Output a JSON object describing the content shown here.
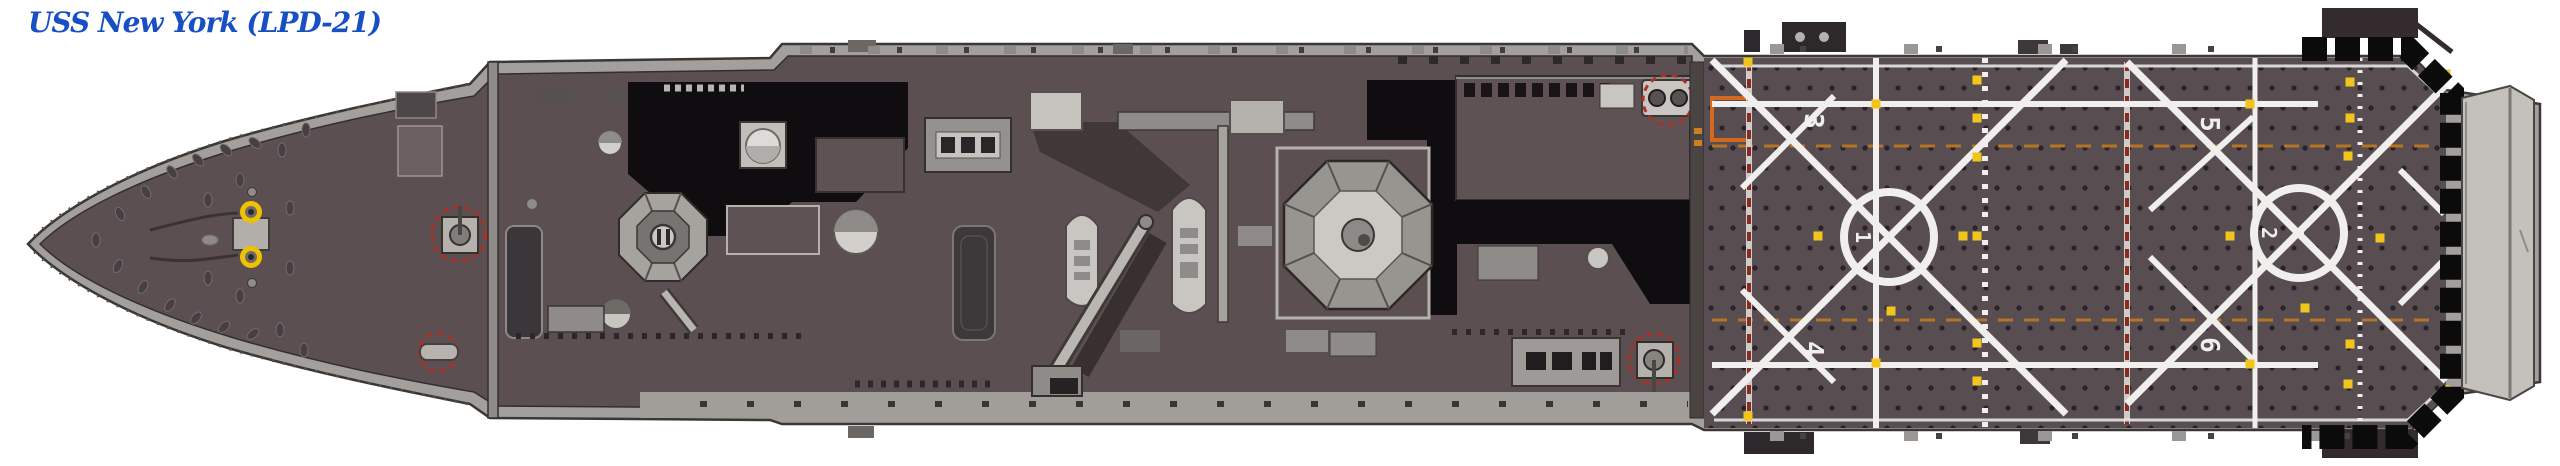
{
  "title": "USS New York (LPD-21)",
  "ship": {
    "name": "USS New York",
    "hull_designation": "LPD-21",
    "view": "overhead deck plan",
    "flight_deck": {
      "spot_labels": {
        "spot1": "1",
        "spot2": "2"
      },
      "line_labels": {
        "line3": "3",
        "line4": "4",
        "line5": "5",
        "line6": "6"
      }
    },
    "colors": {
      "title_blue": "#1850c4",
      "deck_maroon": "#5c4f51",
      "flight_deck": "#584e52",
      "hull_trim": "#a39f9c",
      "superstructure_light": "#c7c4c0",
      "shadow_black": "#0f0d0f",
      "marking_white": "#f0efed",
      "tie_down_yellow": "#f2c51c",
      "warning_red": "#a93226",
      "warning_orange": "#cd7d22"
    }
  }
}
